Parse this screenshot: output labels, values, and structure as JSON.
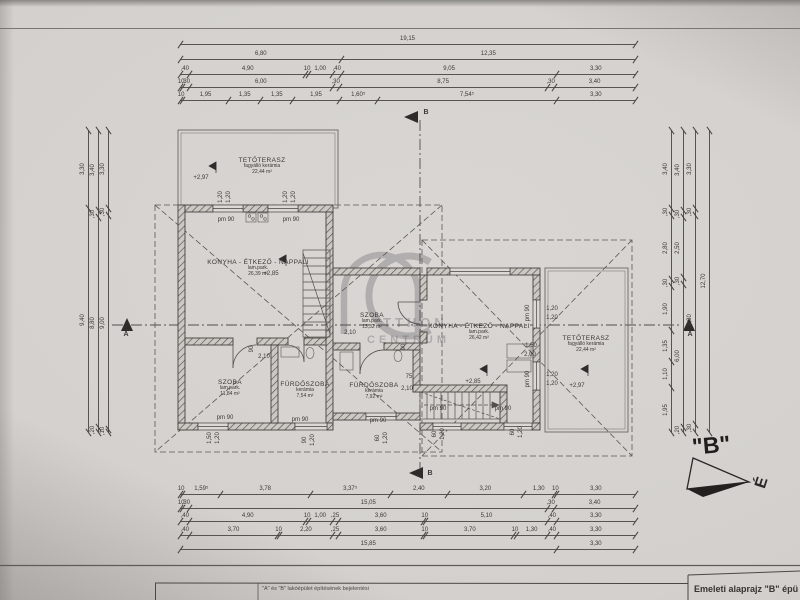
{
  "document": {
    "kind": "scanned floor plan drawing",
    "orientation_label": "\"B\"",
    "north_letter": "É",
    "title_block": {
      "subject_line": "\"A\" és \"B\" lakóépület építésének bejelentési",
      "drawing_title": "Emeleti alaprajz \"B\" épü"
    }
  },
  "colors": {
    "paper": "#d4d1ce",
    "ink": "#3b3936",
    "wall_hatch": "#55524e",
    "watermark": "#4b4a52"
  },
  "watermark": {
    "line1": "TTHON",
    "line2": "CENTRUM"
  },
  "rooms": [
    {
      "name": "TETŐTERASZ",
      "floor": "fagyálló kerámia",
      "area": "22,44 m²",
      "x": 262,
      "y": 166
    },
    {
      "name": "KONYHA - ÉTKEZŐ - NAPPALI",
      "floor": "lam.park.",
      "area": "26,39 m²",
      "x": 258,
      "y": 268
    },
    {
      "name": "SZOBA",
      "floor": "lam.park.",
      "area": "11,84 m²",
      "x": 230,
      "y": 388
    },
    {
      "name": "FÜRDŐSZOBA",
      "floor": "kerámia",
      "area": "7,54 m²",
      "x": 305,
      "y": 390
    },
    {
      "name": "SZOBA",
      "floor": "lam.park.",
      "area": "13,32 m²",
      "x": 372,
      "y": 321
    },
    {
      "name": "FÜRDŐSZOBA",
      "floor": "kerámia",
      "area": "7,92 m²",
      "x": 374,
      "y": 391
    },
    {
      "name": "KONYHA - ÉTKEZŐ - NAPPALI",
      "floor": "lam.park.",
      "area": "26,42 m²",
      "x": 479,
      "y": 332
    },
    {
      "name": "TETŐTERASZ",
      "floor": "fagyálló kerámia",
      "area": "22,44 m²",
      "x": 586,
      "y": 344
    }
  ],
  "dim_chains": {
    "top": {
      "x": 180,
      "w": 455,
      "rows": [
        {
          "y": 44,
          "vals": [
            "19,15"
          ]
        },
        {
          "y": 59,
          "vals": [
            "6,80",
            "12,35"
          ]
        },
        {
          "y": 74,
          "vals": [
            ",40",
            "4,90",
            "10",
            "1,00",
            ",40",
            "9,05",
            "3,30"
          ]
        },
        {
          "y": 87,
          "vals": [
            "10",
            ",30",
            "6,00",
            ",30",
            "8,75",
            ",30",
            "3,40"
          ]
        },
        {
          "y": 100,
          "vals": [
            "10",
            "1,95",
            "1,35",
            "1,35",
            "1,95",
            "1,60⁵",
            "7,54⁵",
            "3,30"
          ]
        }
      ]
    },
    "bottom": {
      "x": 180,
      "w": 455,
      "rows": [
        {
          "y": 494,
          "vals": [
            "10",
            "1,59⁵",
            "3,78",
            "3,37⁵",
            "2,40",
            "3,20",
            "1,30",
            "10",
            "3,30"
          ]
        },
        {
          "y": 508,
          "vals": [
            "10",
            ",30",
            "15,05",
            ",30",
            "3,40"
          ]
        },
        {
          "y": 521,
          "vals": [
            ",40",
            "4,90",
            "10",
            "1,00",
            ",25",
            "3,60",
            "10",
            "5,10",
            ",40",
            "3,30"
          ]
        },
        {
          "y": 535,
          "vals": [
            ",40",
            "3,70",
            "10",
            "2,20",
            ",25",
            "3,60",
            "10",
            "3,70",
            "10",
            "1,30",
            ",40",
            "3,30"
          ]
        },
        {
          "y": 549,
          "vals": [
            "15,85",
            "3,30"
          ]
        }
      ]
    },
    "left": {
      "y": 130,
      "h": 302,
      "cols": [
        {
          "x": 88,
          "vals": [
            "3,30",
            "9,40"
          ]
        },
        {
          "x": 98,
          "vals": [
            "3,40",
            ",30",
            "8,80",
            ",20"
          ]
        },
        {
          "x": 108,
          "vals": [
            "3,30",
            ",30",
            "9,00",
            ",10"
          ]
        }
      ]
    },
    "right": {
      "y": 130,
      "h": 302,
      "cols": [
        {
          "x": 671,
          "vals": [
            "3,40",
            ",30",
            "2,80",
            ",30",
            "1,90",
            "1,35",
            "1,10",
            "1,95"
          ]
        },
        {
          "x": 683,
          "vals": [
            "3,40",
            ",30",
            "2,50",
            ",30",
            "6,00",
            ",20"
          ]
        },
        {
          "x": 695,
          "vals": [
            "3,30",
            ",30",
            "8,80",
            ",30"
          ]
        },
        {
          "x": 709,
          "vals": [
            "12,70"
          ]
        }
      ]
    }
  },
  "annotations": [
    {
      "t": "+2,97",
      "x": 201,
      "y": 178
    },
    {
      "t": "pm 90",
      "x": 226,
      "y": 220
    },
    {
      "t": "pm 90",
      "x": 291,
      "y": 220
    },
    {
      "t": "1,20",
      "x": 221,
      "y": 197,
      "r": 1
    },
    {
      "t": "1,20",
      "x": 229,
      "y": 197,
      "r": 1
    },
    {
      "t": "1,20",
      "x": 286,
      "y": 197,
      "r": 1
    },
    {
      "t": "1,20",
      "x": 294,
      "y": 197,
      "r": 1
    },
    {
      "t": "+2,85",
      "x": 271,
      "y": 274
    },
    {
      "t": "90",
      "x": 252,
      "y": 349,
      "r": 1
    },
    {
      "t": "2,10",
      "x": 264,
      "y": 357
    },
    {
      "t": "pm 90",
      "x": 225,
      "y": 418
    },
    {
      "t": "pm 90",
      "x": 300,
      "y": 420
    },
    {
      "t": "1,50",
      "x": 210,
      "y": 438,
      "r": 1
    },
    {
      "t": "1,20",
      "x": 218,
      "y": 438,
      "r": 1
    },
    {
      "t": "90",
      "x": 305,
      "y": 440,
      "r": 1
    },
    {
      "t": "1,20",
      "x": 313,
      "y": 440,
      "r": 1
    },
    {
      "t": "60",
      "x": 378,
      "y": 438,
      "r": 1
    },
    {
      "t": "1,20",
      "x": 386,
      "y": 438,
      "r": 1
    },
    {
      "t": "60",
      "x": 435,
      "y": 434,
      "r": 1
    },
    {
      "t": "1,20",
      "x": 443,
      "y": 434,
      "r": 1
    },
    {
      "t": "60",
      "x": 513,
      "y": 432,
      "r": 1
    },
    {
      "t": "1,20",
      "x": 521,
      "y": 432,
      "r": 1
    },
    {
      "t": "pm 90",
      "x": 438,
      "y": 409
    },
    {
      "t": "pm 90",
      "x": 503,
      "y": 409
    },
    {
      "t": "pm 90",
      "x": 378,
      "y": 421
    },
    {
      "t": "75",
      "x": 409,
      "y": 377
    },
    {
      "t": "2,10",
      "x": 407,
      "y": 389
    },
    {
      "t": "90",
      "x": 404,
      "y": 347,
      "r": 1
    },
    {
      "t": "2,10",
      "x": 350,
      "y": 333
    },
    {
      "t": "1,50",
      "x": 531,
      "y": 346
    },
    {
      "t": "2,00",
      "x": 530,
      "y": 355
    },
    {
      "t": "pm 90",
      "x": 528,
      "y": 313,
      "r": 1
    },
    {
      "t": "1,20",
      "x": 552,
      "y": 309
    },
    {
      "t": "1,20",
      "x": 552,
      "y": 318
    },
    {
      "t": "pm 90",
      "x": 528,
      "y": 379,
      "r": 1
    },
    {
      "t": "1,20",
      "x": 552,
      "y": 375
    },
    {
      "t": "1,20",
      "x": 552,
      "y": 384
    },
    {
      "t": "+2,97",
      "x": 577,
      "y": 386
    },
    {
      "t": "+2,85",
      "x": 473,
      "y": 382
    },
    {
      "t": "A",
      "x": 126,
      "y": 335,
      "b": 1
    },
    {
      "t": "A",
      "x": 690,
      "y": 335,
      "b": 1
    },
    {
      "t": "B",
      "x": 426,
      "y": 113,
      "b": 1
    },
    {
      "t": "B",
      "x": 430,
      "y": 474,
      "b": 1
    }
  ]
}
